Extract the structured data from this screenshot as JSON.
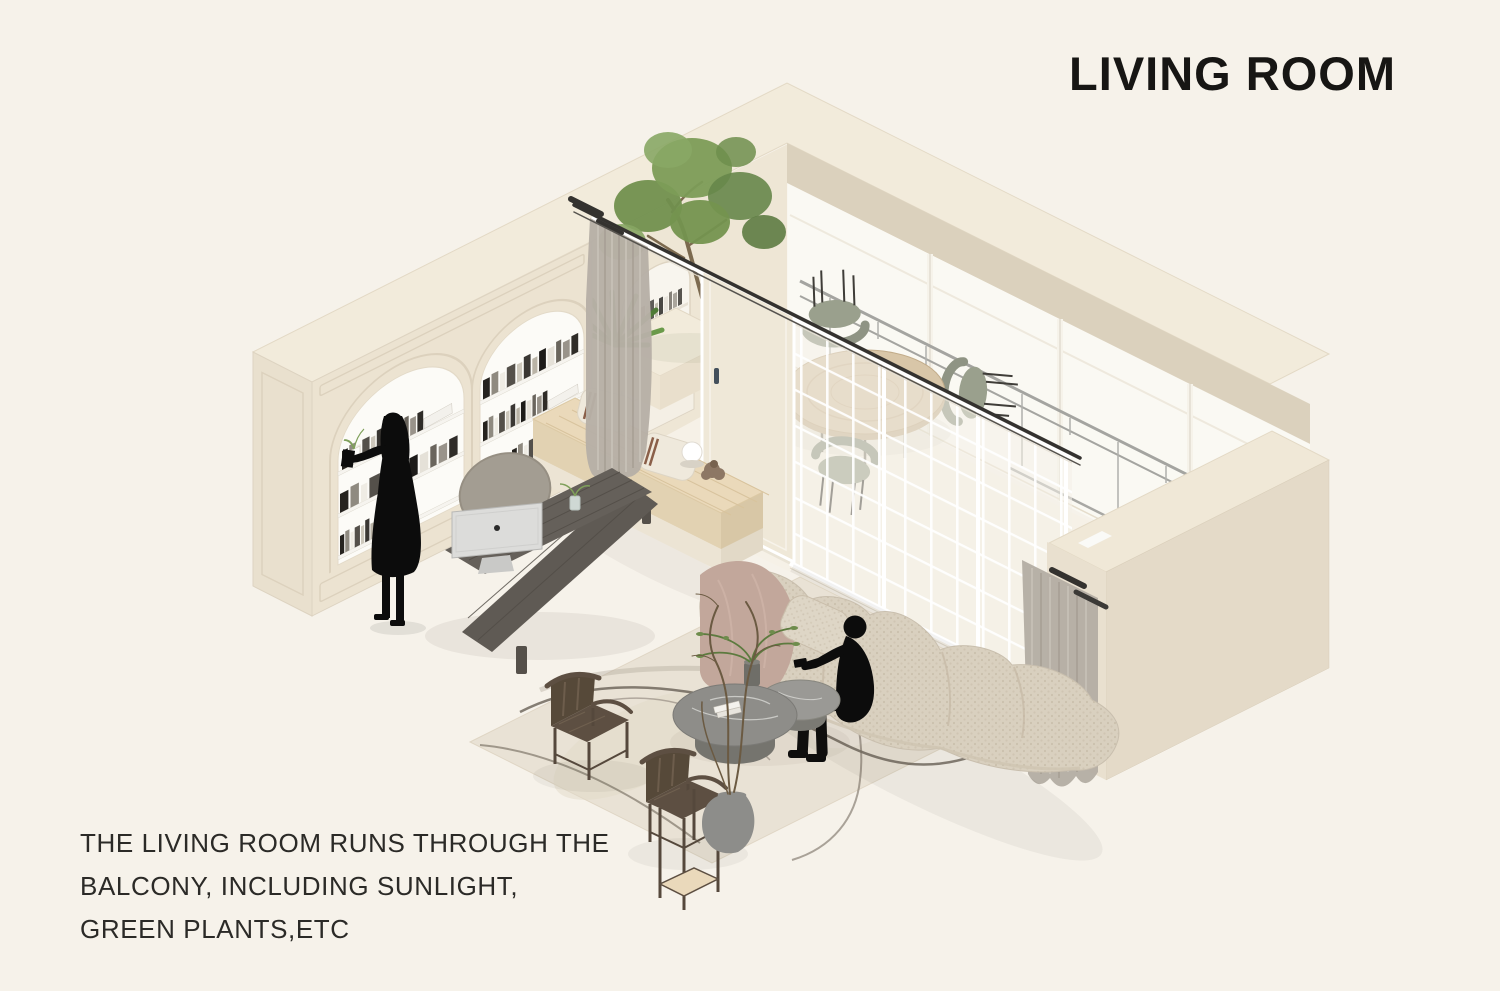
{
  "page": {
    "background": "#f6f2ea"
  },
  "header": {
    "title": "LIVING ROOM",
    "color": "#171614"
  },
  "caption": {
    "lines": [
      "THE LIVING ROOM RUNS THROUGH THE",
      "BALCONY, INCLUDING SUNLIGHT,",
      "GREEN PLANTS,ETC"
    ],
    "color": "#2b2a27"
  },
  "scene": {
    "type": "isometric-interior-illustration",
    "room": "living room connected to a balcony",
    "palette": {
      "background": "#f6f2ea",
      "wall": "#ece3d1",
      "wall_top": "#f2ebdb",
      "wall_side": "#e4dac8",
      "ceiling_band": "#dbd1bd",
      "glass": "#fbfaf5",
      "partition_grid": "#ffffff",
      "railing": "#a4a4a0",
      "wood_bench": "#ead9ba",
      "desk_wood": "#5f5a54",
      "imac": "#dcdcda",
      "sofa_boucle": "#d9d0bf",
      "throw_blanket": "#c2a79b",
      "rug": "#e9e2d4",
      "rug_branch": "#5f574c",
      "plant_green": "#71904e",
      "curtain": "#b7b0a6",
      "antique_wood": "#5d4f42",
      "marble_table": "#8e8d89",
      "silhouette": "#0c0c0c"
    },
    "elements": [
      "arched-bookshelf-wall",
      "standing-woman-silhouette",
      "desk-with-imac",
      "desk-chair",
      "window-bench-with-pillows",
      "glass-grid-partition",
      "open-glass-door",
      "curtain-rod",
      "curtain-left",
      "curtain-right",
      "balcony-tree",
      "fern-plant",
      "balcony-dining-table",
      "dining-chairs",
      "window-wall-with-railing",
      "sofa-with-throw-blanket",
      "sitting-man-silhouette",
      "marble-coffee-tables",
      "coffee-table-plant",
      "area-rug",
      "antique-armchairs",
      "plant-stand",
      "vase-with-branches"
    ]
  }
}
